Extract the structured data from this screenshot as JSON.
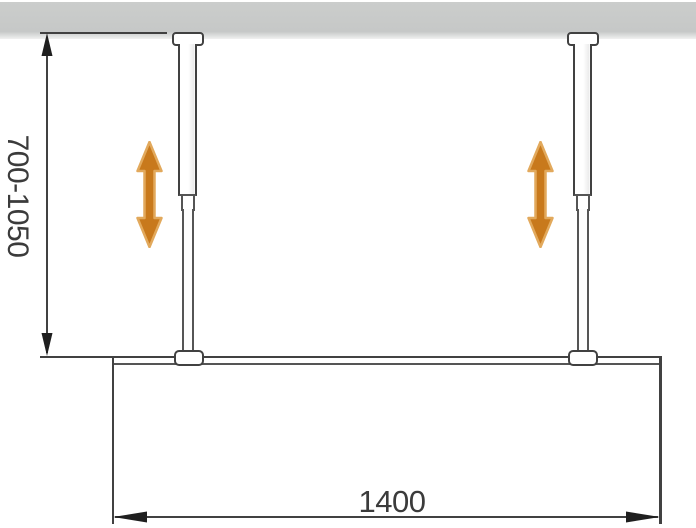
{
  "diagram": {
    "type": "technical-installation-drawing",
    "subject": "walk-in shower glass panel fixed by two height-adjustable ceiling support rods",
    "dimensions": {
      "height_range_label": "700-1050",
      "width_label": "1400"
    },
    "colors": {
      "line": "#414141",
      "line_soft": "#555555",
      "ceiling": "#c6c8c7",
      "arrow_fill": "#c8791c",
      "arrow_halo": "#e2a95c",
      "background": "#ffffff",
      "text": "#3b3b3b",
      "dim_arrow": "#1f1f1f"
    },
    "icons": {
      "adjustability": "double-headed-vertical-arrow"
    }
  }
}
